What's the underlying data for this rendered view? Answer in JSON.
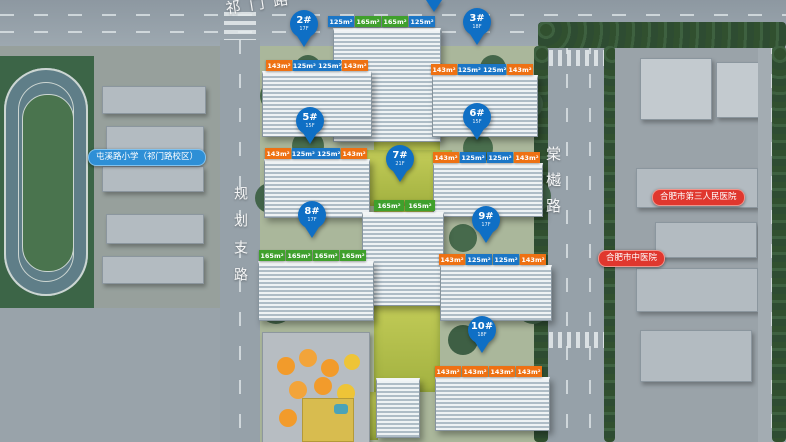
{
  "roads": {
    "top": "祁门路",
    "left": "规划支路",
    "right": "棠樾路"
  },
  "poi": {
    "school": "屯溪路小学（祁门路校区）",
    "hospital_1": "合肥市第三人民医院",
    "hospital_2": "合肥市中医院"
  },
  "colors": {
    "pin_blue": "#0f6fc5",
    "tag_blue": "#1b76c6",
    "tag_green": "#3fa02c",
    "tag_orange": "#ee7113",
    "school_pill": "#2e8fd6",
    "hospital_pill": "#e0372e"
  },
  "buildings": [
    {
      "id": "",
      "floors": "",
      "pin_visible": false,
      "areas": [
        {
          "text": "125m²",
          "color": "blue"
        },
        {
          "text": "165m²",
          "color": "green"
        },
        {
          "text": "165m²",
          "color": "green"
        },
        {
          "text": "125m²",
          "color": "blue"
        }
      ]
    },
    {
      "id": "2#",
      "floors": "17F",
      "pin_visible": true,
      "areas": [
        {
          "text": "143m²",
          "color": "orange"
        },
        {
          "text": "125m² 125m²",
          "color": "blue",
          "wide": true
        },
        {
          "text": "143m²",
          "color": "orange"
        }
      ]
    },
    {
      "id": "3#",
      "floors": "18F",
      "pin_visible": true,
      "areas": [
        {
          "text": "143m²",
          "color": "orange"
        },
        {
          "text": "125m² 125m²",
          "color": "blue",
          "wide": true
        },
        {
          "text": "143m²",
          "color": "orange"
        }
      ]
    },
    {
      "id": "5#",
      "floors": "15F",
      "pin_visible": true,
      "areas": [
        {
          "text": "143m²",
          "color": "orange"
        },
        {
          "text": "125m² 125m²",
          "color": "blue",
          "wide": true
        },
        {
          "text": "143m²",
          "color": "orange"
        }
      ]
    },
    {
      "id": "6#",
      "floors": "15F",
      "pin_visible": true,
      "areas": [
        {
          "text": "143m²",
          "color": "orange"
        },
        {
          "text": "125m²",
          "color": "blue"
        },
        {
          "text": "125m²",
          "color": "blue"
        },
        {
          "text": "143m²",
          "color": "orange"
        }
      ]
    },
    {
      "id": "7#",
      "floors": "21F",
      "pin_visible": true,
      "areas": [
        {
          "text": "165m²",
          "color": "green"
        },
        {
          "text": "165m²",
          "color": "green"
        }
      ]
    },
    {
      "id": "8#",
      "floors": "17F",
      "pin_visible": true,
      "areas": [
        {
          "text": "165m²",
          "color": "green"
        },
        {
          "text": "165m²",
          "color": "green"
        },
        {
          "text": "165m²",
          "color": "green"
        },
        {
          "text": "165m²",
          "color": "green"
        }
      ]
    },
    {
      "id": "9#",
      "floors": "17F",
      "pin_visible": true,
      "areas": [
        {
          "text": "143m²",
          "color": "orange"
        },
        {
          "text": "125m²",
          "color": "blue"
        },
        {
          "text": "125m²",
          "color": "blue"
        },
        {
          "text": "143m²",
          "color": "orange"
        }
      ]
    },
    {
      "id": "10#",
      "floors": "18F",
      "pin_visible": true,
      "areas": [
        {
          "text": "143m²",
          "color": "orange"
        },
        {
          "text": "143m²",
          "color": "orange"
        },
        {
          "text": "143m²",
          "color": "orange"
        },
        {
          "text": "143m²",
          "color": "orange"
        }
      ]
    }
  ]
}
